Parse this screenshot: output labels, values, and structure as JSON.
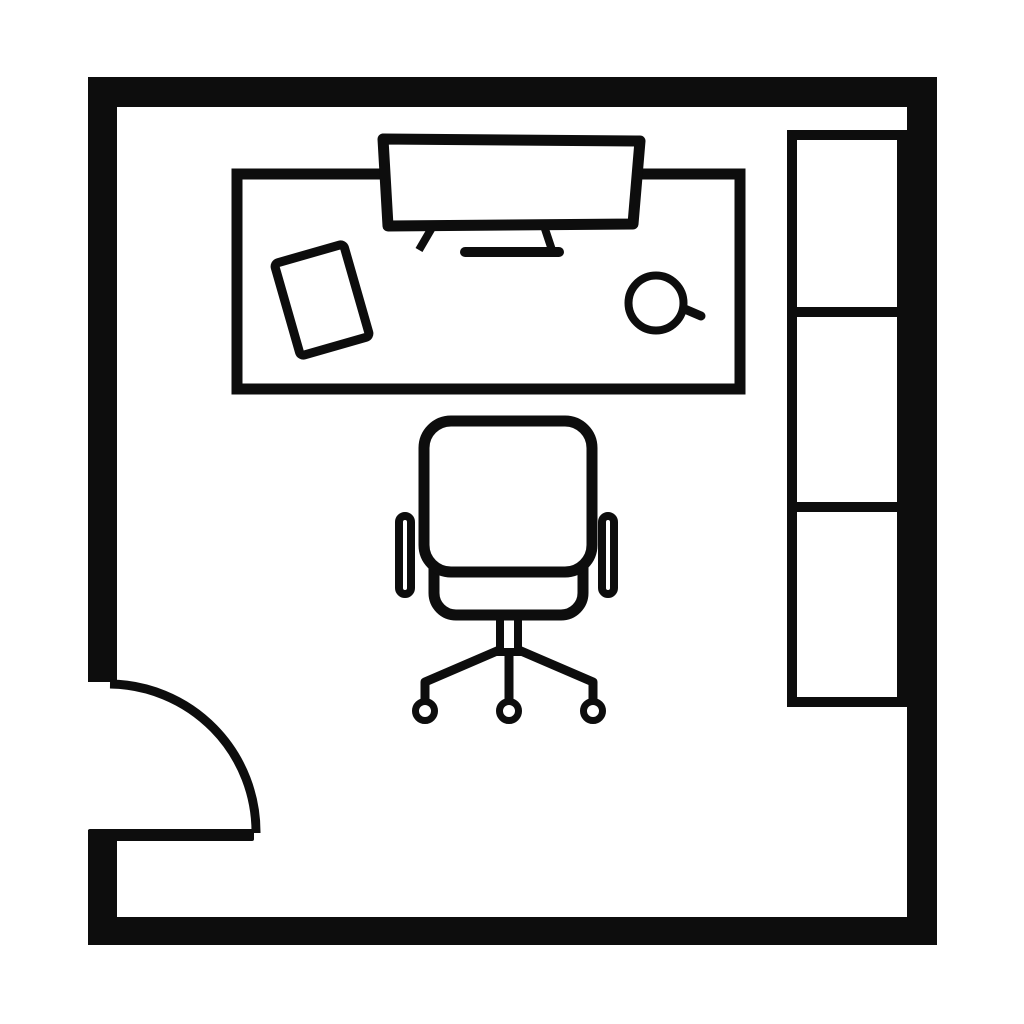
{
  "page": {
    "title": "Office room floor plan"
  },
  "colors": {
    "line": "#0d0d0d",
    "background": "#ffffff"
  },
  "diagram": {
    "type": "floor-plan",
    "room": {
      "shape": "rectangular",
      "wall_style": "thick solid black",
      "door": {
        "position": "bottom-left wall",
        "swing": "quarter-circle arc opening into room"
      }
    },
    "furniture": [
      {
        "name": "desk",
        "location": "upper area, horizontal rectangle"
      },
      {
        "name": "monitor",
        "location": "on desk, top center, slightly tilted"
      },
      {
        "name": "tablet",
        "location": "on desk, left side, tilted ~16 degrees"
      },
      {
        "name": "mouse",
        "location": "on desk, right side, round with short tail"
      },
      {
        "name": "office-chair",
        "location": "center of room below desk",
        "details": "backrest, seat, two armrests, center post, 3-leg star base with casters"
      },
      {
        "name": "shelf-unit",
        "location": "along right wall",
        "compartments": 3
      }
    ]
  }
}
